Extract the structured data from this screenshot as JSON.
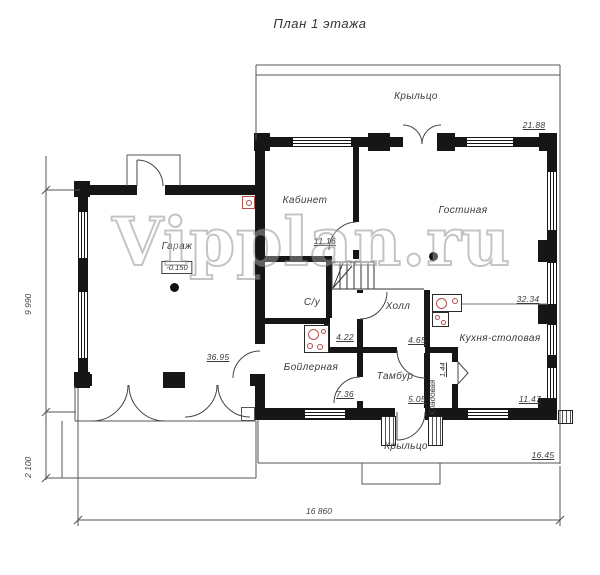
{
  "title": "План 1 этажа",
  "watermark": "Vipplan.ru",
  "colors": {
    "wall": "#161616",
    "fixture_red": "#b5504a",
    "thin_line": "#555555"
  },
  "rooms": [
    {
      "id": "porch-top",
      "label": "Крыльцо",
      "area": "21.88"
    },
    {
      "id": "kabinet",
      "label": "Кабинет",
      "area": "11.16"
    },
    {
      "id": "gostinaya",
      "label": "Гостиная",
      "area": "32.34"
    },
    {
      "id": "garage",
      "label": "Гараж",
      "area": "36.95",
      "level": "-0.150"
    },
    {
      "id": "su",
      "label": "С/у",
      "area": "4.22"
    },
    {
      "id": "holl",
      "label": "Холл",
      "area": "4.65"
    },
    {
      "id": "boilernaya",
      "label": "Бойлерная",
      "area": "7.36"
    },
    {
      "id": "tambur",
      "label": "Тамбур",
      "area": "5.05"
    },
    {
      "id": "kladovaya",
      "label": "Кладовая",
      "area": "1.44"
    },
    {
      "id": "kitchen",
      "label": "Кухня-столовая",
      "area": "11.47"
    },
    {
      "id": "porch-bottom",
      "label": "Крыльцо",
      "area": "16.45"
    }
  ],
  "dimensions": {
    "total_width": "16 860",
    "main_height": "9 990",
    "porch_height": "2 100"
  }
}
